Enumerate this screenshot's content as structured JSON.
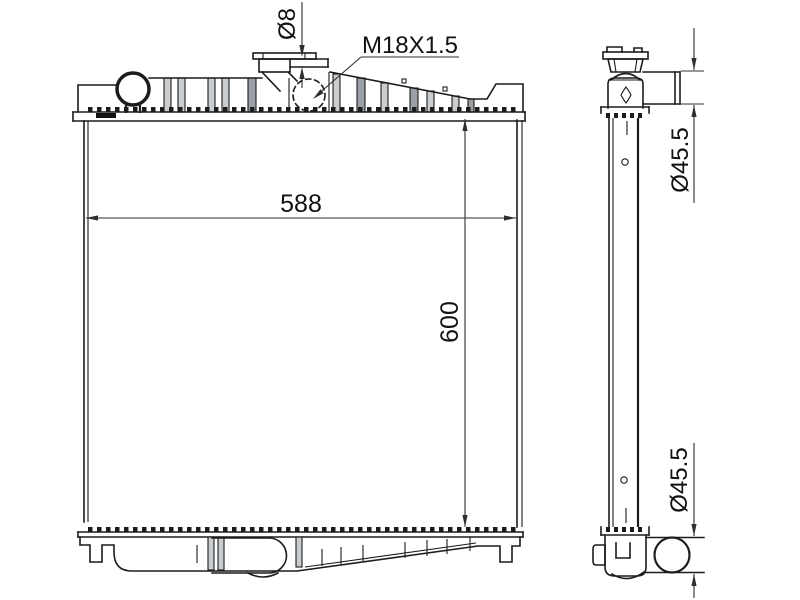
{
  "drawing": {
    "type": "radiator-technical-drawing",
    "background": "#ffffff",
    "line_color": "#1c1c1c",
    "dimension_color": "#2f2f2f",
    "rib_shade_light": "#c9cdd0",
    "rib_shade_dark": "#9aa0a5",
    "annotations": {
      "overflow_pipe_diameter": "Ø8",
      "filler_neck_thread": "M18X1.5",
      "core_width": "588",
      "core_height": "600",
      "top_pipe_diameter": "Ø45.5",
      "bottom_pipe_diameter": "Ø45.5"
    }
  }
}
